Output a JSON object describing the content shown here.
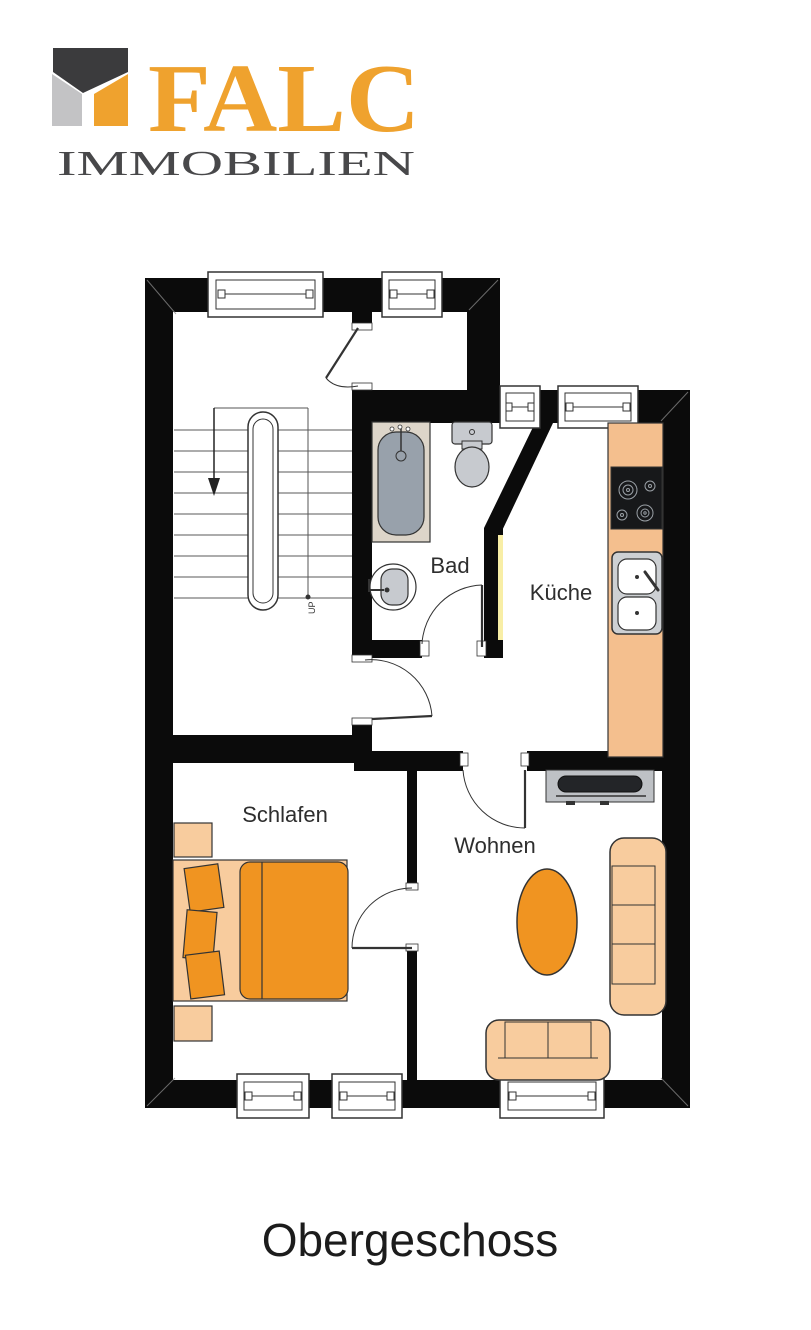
{
  "logo": {
    "brand": "FALC",
    "subtitle": "IMMOBILIEN"
  },
  "floor_caption": "Obergeschoss",
  "plan": {
    "room_labels": [
      {
        "name": "bad",
        "label": "Bad"
      },
      {
        "name": "kueche",
        "label": "Küche"
      },
      {
        "name": "schlafen",
        "label": "Schlafen"
      },
      {
        "name": "wohnen",
        "label": "Wohnen"
      }
    ],
    "stair_label": "UP"
  },
  "colors": {
    "wall": "#0b0b0b",
    "brand_orange": "#efa22e",
    "brand_gray": "#c3c3c5",
    "brand_dark": "#3b3b3d",
    "furniture_orange": "#f09421",
    "furniture_peach": "#f8cc9e",
    "counter_peach": "#f4bf8e",
    "fixture_gray": "#c7cacf",
    "tub_gray": "#98a1ab",
    "sideboard_gray": "#bec1c5",
    "highlight_yellow": "#f8eea6",
    "label_color": "#2e2e2e"
  }
}
